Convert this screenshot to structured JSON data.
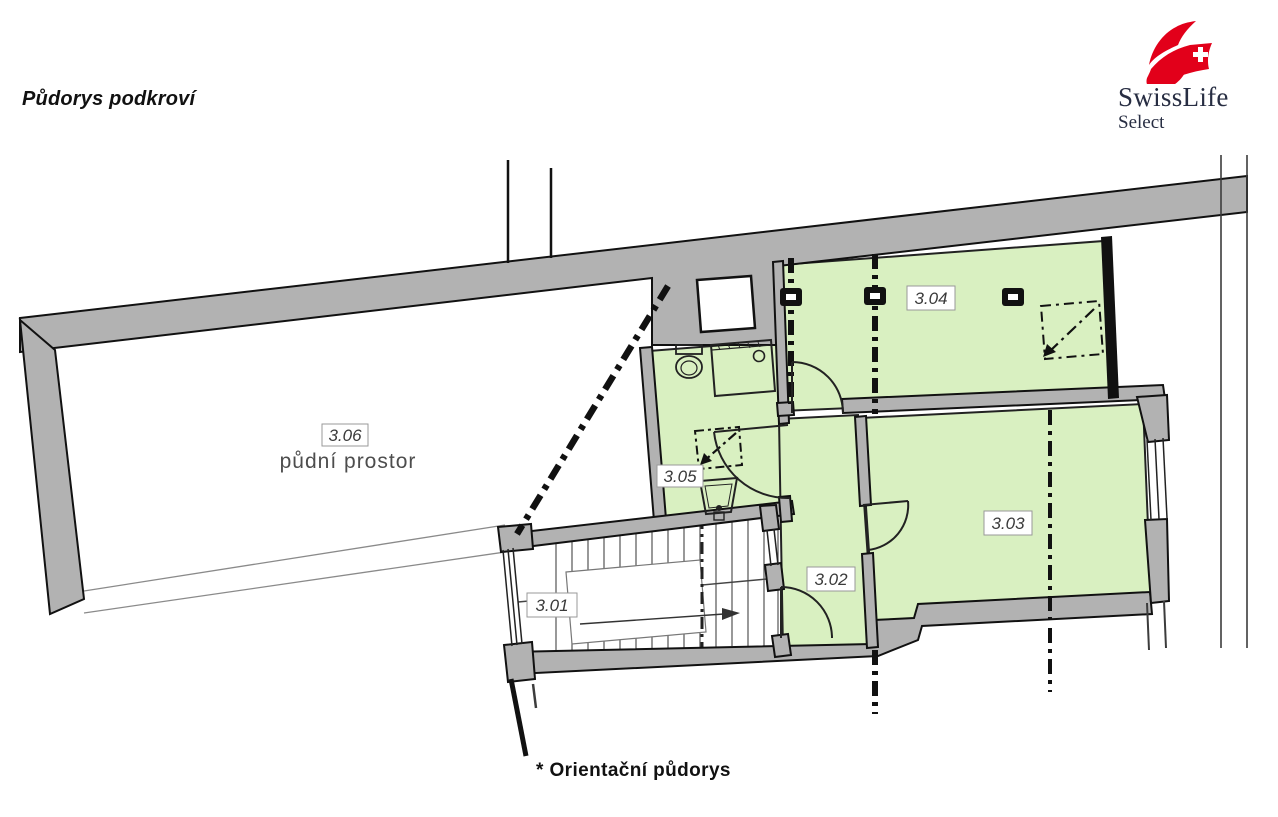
{
  "header": {
    "title": "Půdorys podkroví"
  },
  "logo": {
    "brand": "SwissLife",
    "subtitle": "Select",
    "red": "#e2001a",
    "text_color": "#272d42"
  },
  "footer": {
    "note": "* Orientační půdorys"
  },
  "floorplan": {
    "colors": {
      "room_green": "#d9f0c1",
      "wall_gray": "#b2b2b2",
      "line_black": "#1a1a1a"
    },
    "attic_name": "půdní prostor",
    "rooms": [
      {
        "label": "3.01"
      },
      {
        "label": "3.02"
      },
      {
        "label": "3.03"
      },
      {
        "label": "3.04"
      },
      {
        "label": "3.05"
      },
      {
        "label": "3.06"
      }
    ]
  }
}
